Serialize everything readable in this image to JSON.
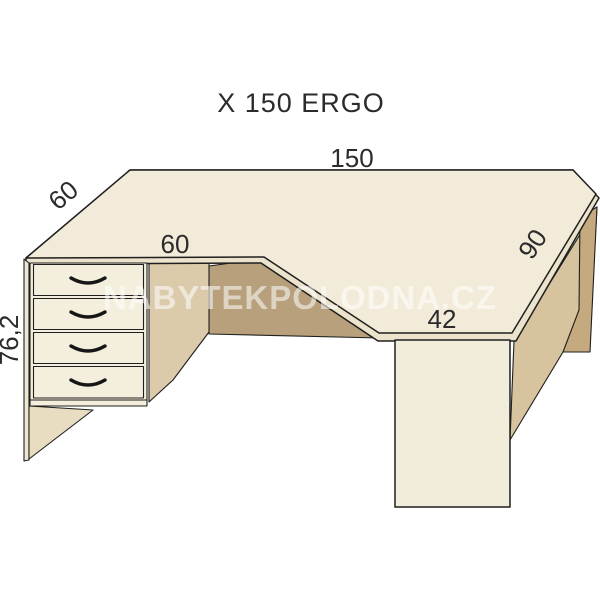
{
  "title": "X 150 ERGO",
  "watermark": "NABYTEKPOLODNA.CZ",
  "dimensions": {
    "back_width": "150",
    "left_depth": "60",
    "kneehole_width": "60",
    "right_depth": "90",
    "right_front_width": "42",
    "height": "76,2"
  },
  "colors": {
    "desktop_top": "#f2ebd9",
    "desktop_edge": "#ece3cd",
    "drawer_front": "#f4eedd",
    "pedestal_side": "#dccbab",
    "kneehole_panel": "#b7a07b",
    "right_panel_inner": "#d7c39d",
    "right_panel_edge": "#c5a97f",
    "left_panel_foot": "#e8dcc1",
    "left_panel_edge": "#efe7d3",
    "leg_front": "#f2ecda",
    "label_text": "#2b2b2b",
    "watermark_color": "#ffffff"
  }
}
